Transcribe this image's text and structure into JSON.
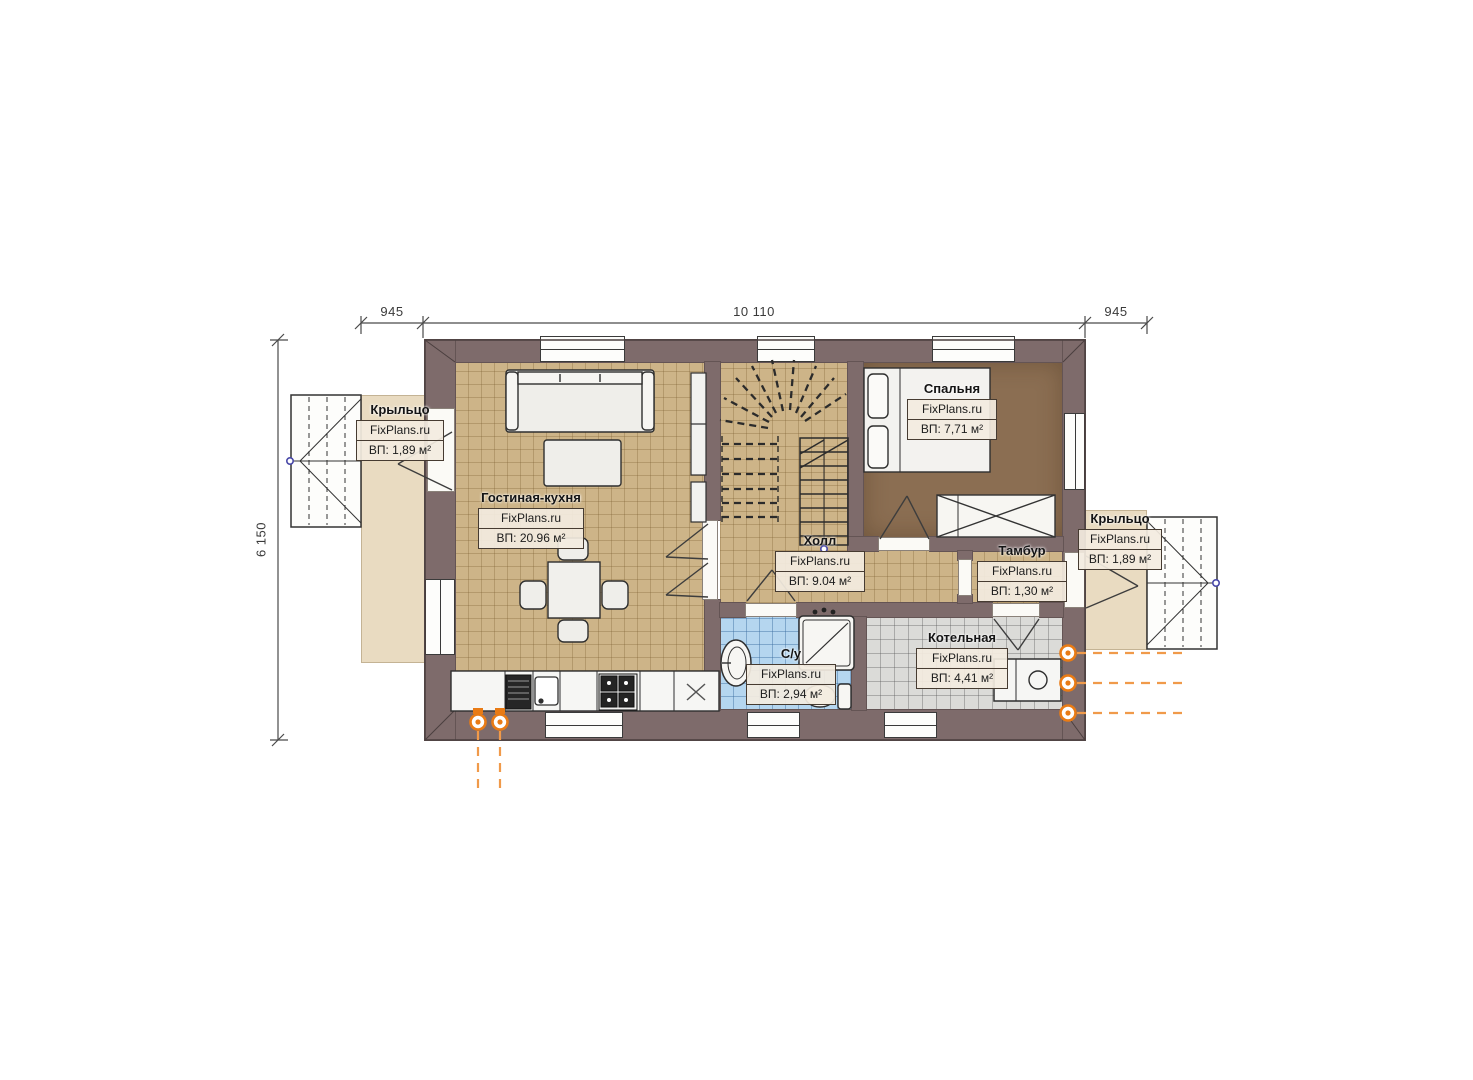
{
  "watermark": "FixPlans.ru",
  "dimensions": {
    "top_left": "945",
    "top_center": "10 110",
    "top_right": "945",
    "left": "6 150"
  },
  "rooms": [
    {
      "key": "porch-left",
      "name": "Крыльцо",
      "brand": "FixPlans.ru",
      "area": "ВП: 1,89 м²"
    },
    {
      "key": "living-kitchen",
      "name": "Гостиная-кухня",
      "brand": "FixPlans.ru",
      "area": "ВП: 20.96 м²"
    },
    {
      "key": "hall",
      "name": "Холл",
      "brand": "FixPlans.ru",
      "area": "ВП: 9.04 м²"
    },
    {
      "key": "bedroom",
      "name": "Спальня",
      "brand": "FixPlans.ru",
      "area": "ВП: 7,71 м²"
    },
    {
      "key": "vestibule",
      "name": "Тамбур",
      "brand": "FixPlans.ru",
      "area": "ВП: 1,30 м²"
    },
    {
      "key": "bathroom",
      "name": "С/у",
      "brand": "FixPlans.ru",
      "area": "ВП: 2,94 м²"
    },
    {
      "key": "boiler",
      "name": "Котельная",
      "brand": "FixPlans.ru",
      "area": "ВП: 4,41 м²"
    },
    {
      "key": "porch-right",
      "name": "Крыльцо",
      "brand": "FixPlans.ru",
      "area": "ВП: 1,89 м²"
    }
  ],
  "colors": {
    "wall": "#7e6b6b",
    "floor_main": "#cdb488",
    "floor_bedroom": "#8b6e52",
    "floor_bathroom": "#b5d6ef",
    "floor_boiler": "#dbdbd8",
    "porch_slab": "#e9dbc1",
    "utility_orange": "#e97b15",
    "handle_blue": "#4848a8"
  }
}
